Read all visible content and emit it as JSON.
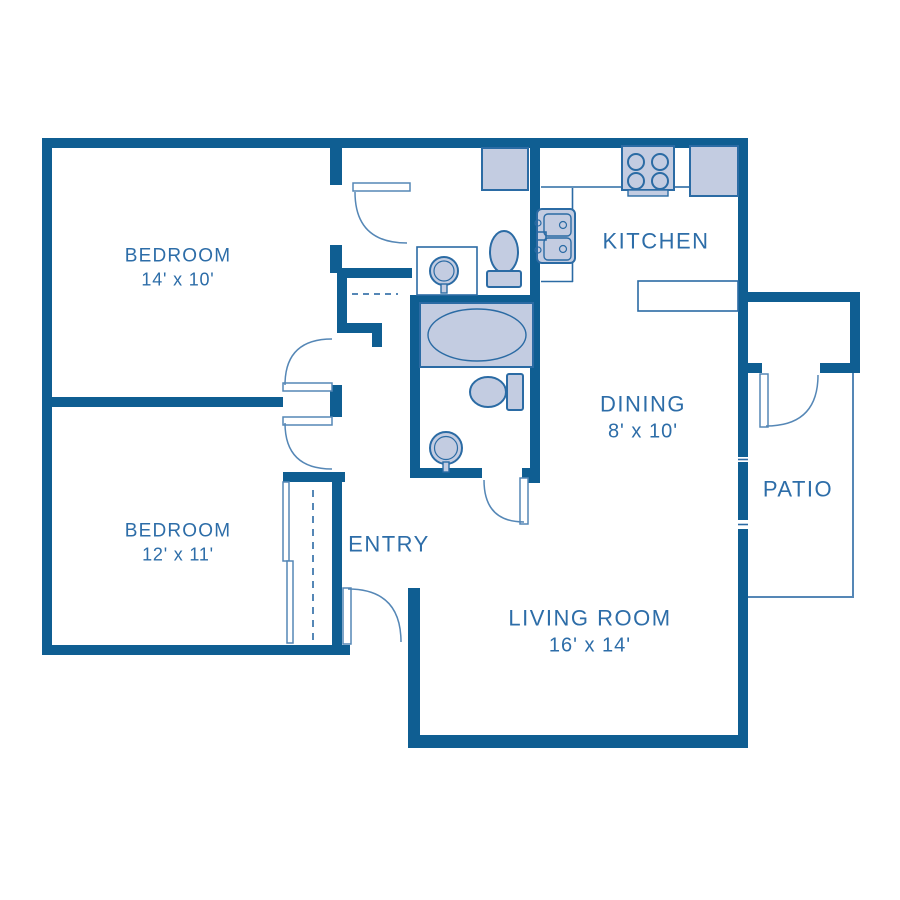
{
  "title": "Two Bedroom Apartment Floor Plan",
  "colors": {
    "wall": "#0f5e92",
    "fixture_outline": "#2b6ba4",
    "door_arc": "#5587b6",
    "fixture_fill": "#c3cce1",
    "text": "#2d6da8",
    "background": "#ffffff"
  },
  "rooms": {
    "bedroom1": {
      "label": "BEDROOM",
      "dims": "14' x 10'"
    },
    "bedroom2": {
      "label": "BEDROOM",
      "dims": "12' x 11'"
    },
    "kitchen": {
      "label": "KITCHEN"
    },
    "dining": {
      "label": "DINING",
      "dims": "8' x 10'"
    },
    "living": {
      "label": "LIVING ROOM",
      "dims": "16' x 14'"
    },
    "entry": {
      "label": "ENTRY"
    },
    "patio": {
      "label": "PATIO"
    }
  },
  "fixtures": [
    "stove-icon",
    "refrigerator-icon",
    "kitchen-sink-icon",
    "breakfast-bar",
    "shower-closet",
    "vanity-counter",
    "round-sink-icon",
    "toilet-icon",
    "bathtub-icon",
    "linen-closet-dashes",
    "closet-rod-dashes",
    "door-swing-arcs"
  ]
}
